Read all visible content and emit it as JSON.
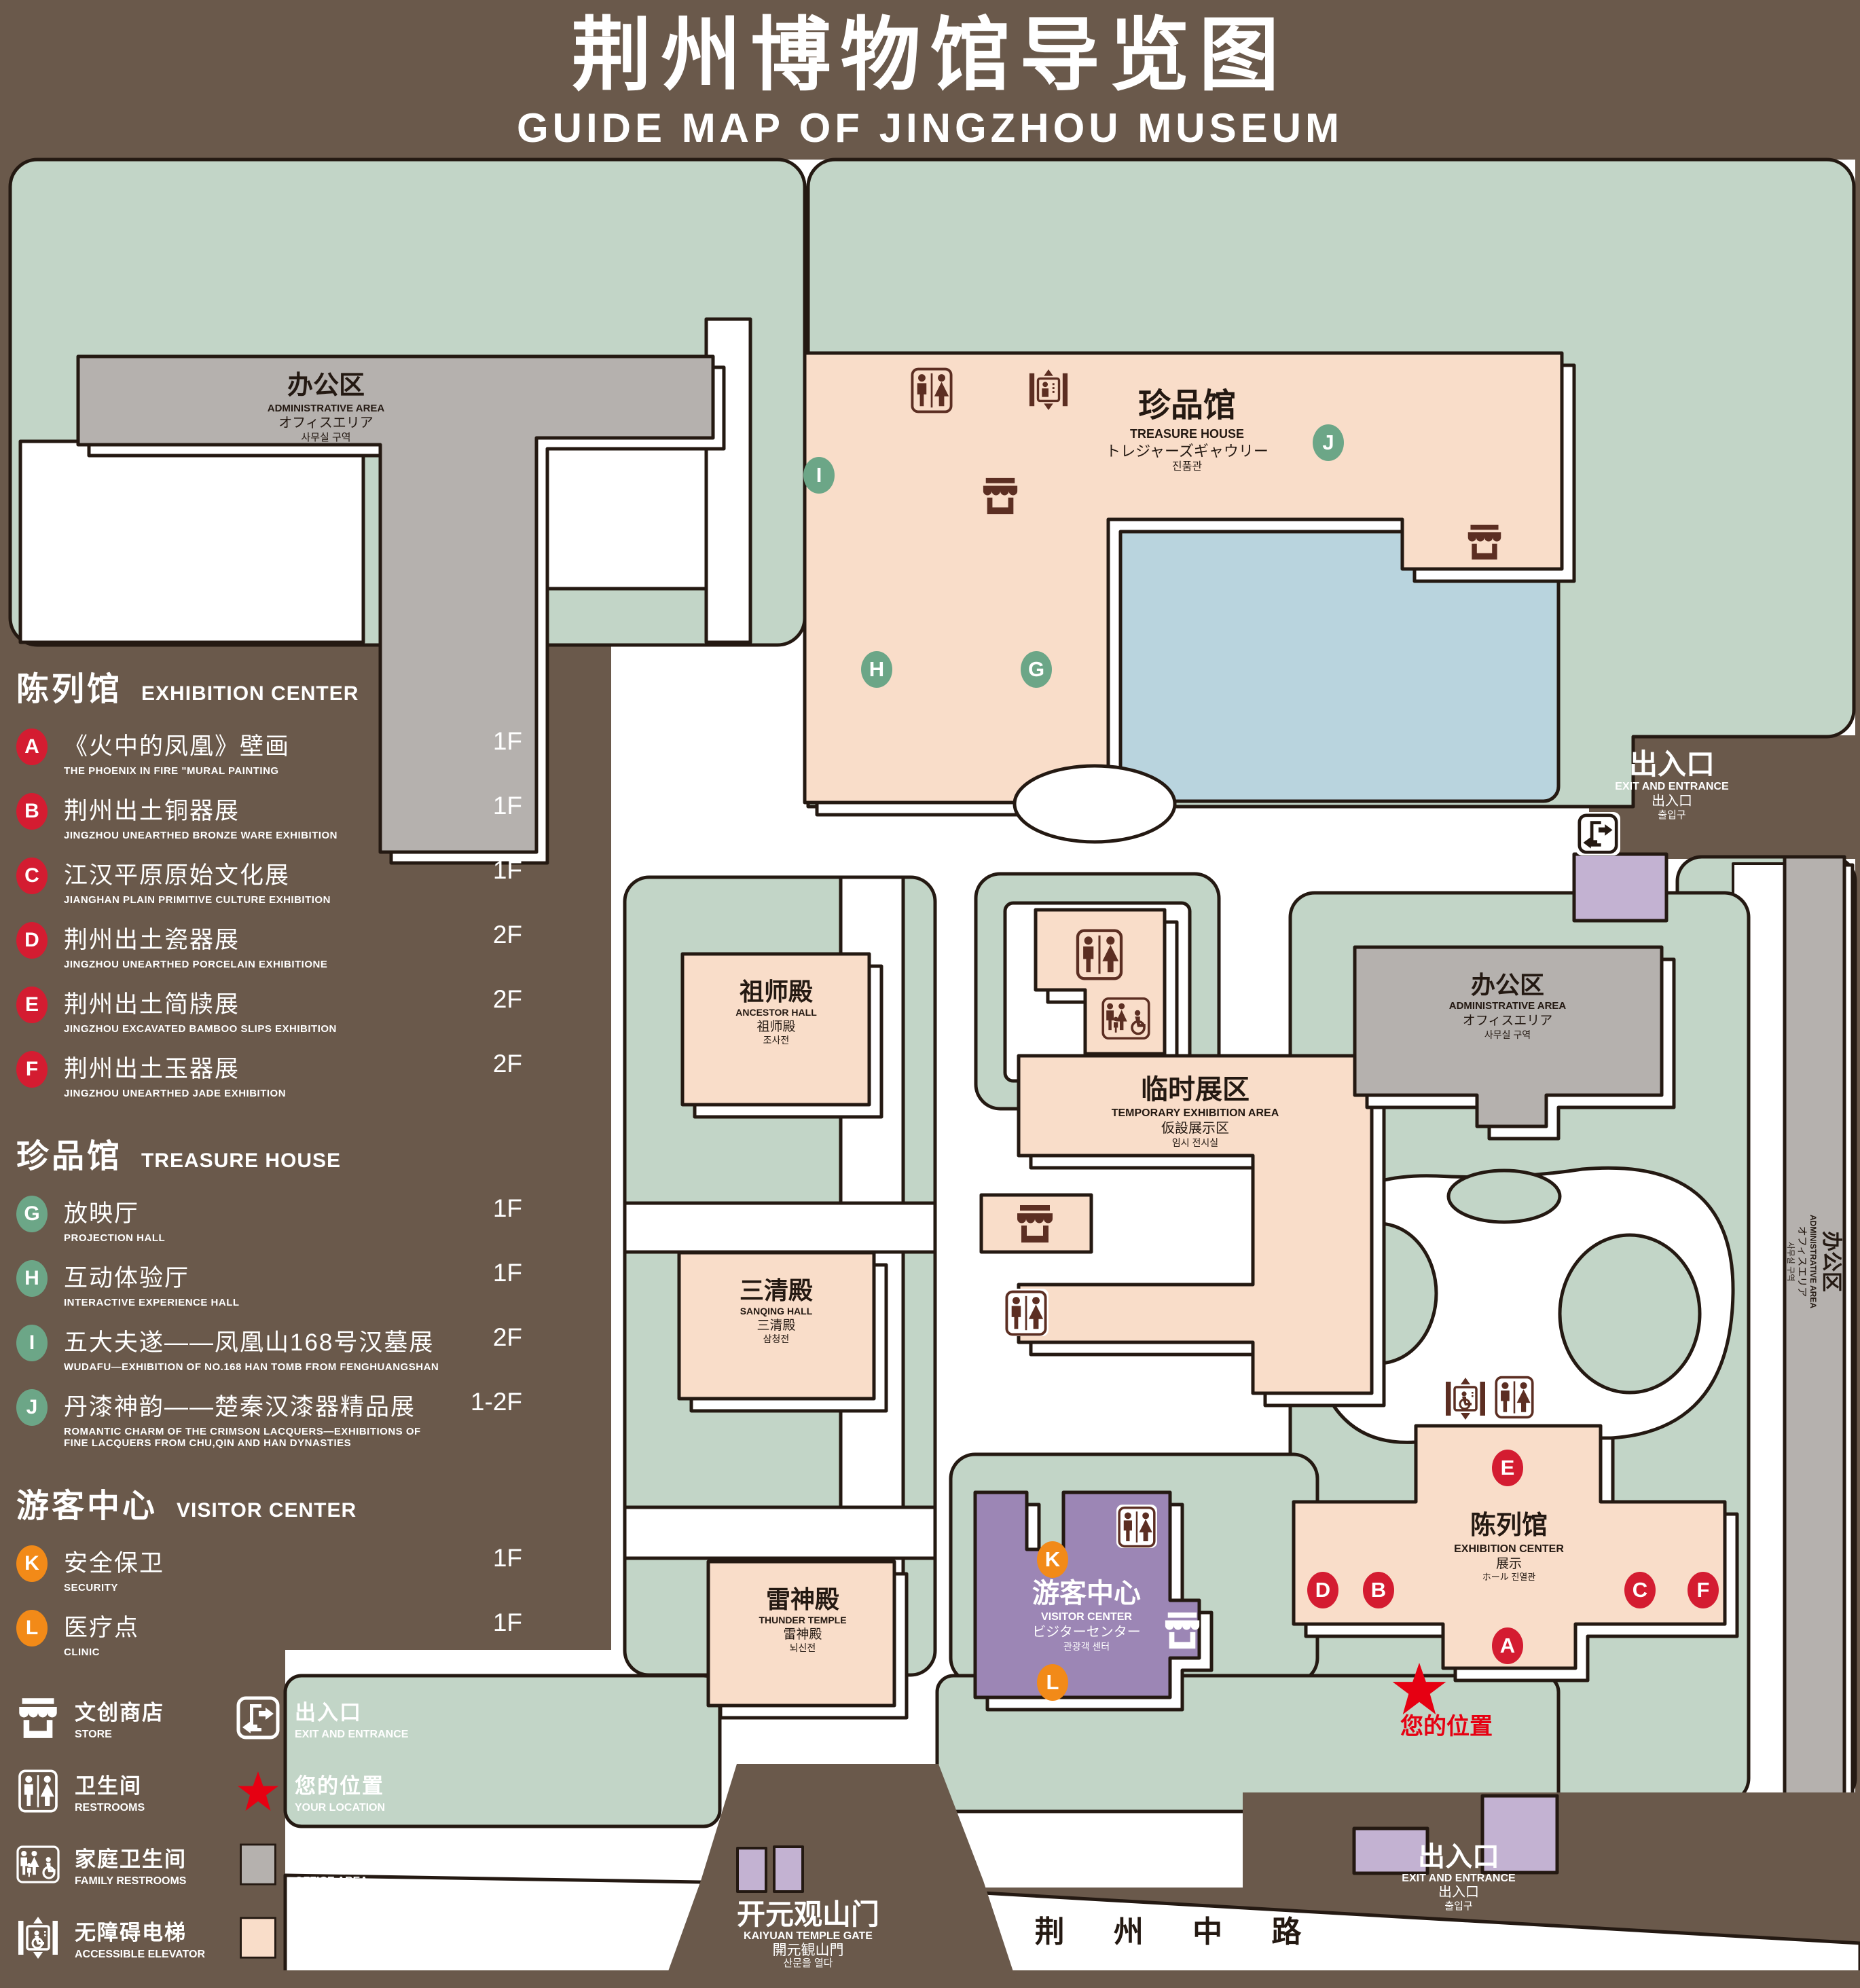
{
  "title": {
    "zh": "荆州博物馆导览图",
    "en": "GUIDE MAP OF JINGZHOU MUSEUM"
  },
  "colors": {
    "background_brown": "#6a594b",
    "map_green": "#c2d5c7",
    "path_white": "#ffffff",
    "building_pink": "#f9ddc9",
    "building_gray": "#b5b1ae",
    "lake_blue": "#b9d4de",
    "visitor_purple": "#9c86b5",
    "lavender": "#c3b2d2",
    "outline": "#241912",
    "badge_red": "#d41c31",
    "badge_green": "#6ca687",
    "badge_orange": "#f28a18",
    "icon_brown": "#5c2e22",
    "star_red": "#e60012"
  },
  "legend": {
    "sections": [
      {
        "zh": "陈列馆",
        "en": "EXHIBITION CENTER",
        "badge_color": "#d41c31",
        "items": [
          {
            "letter": "A",
            "zh": "《火中的凤凰》壁画",
            "en": "THE PHOENIX IN FIRE \"MURAL PAINTING",
            "floor": "1F",
            "badge_color": "#d41c31"
          },
          {
            "letter": "B",
            "zh": "荆州出土铜器展",
            "en": "JINGZHOU UNEARTHED BRONZE WARE EXHIBITION",
            "floor": "1F",
            "badge_color": "#d41c31"
          },
          {
            "letter": "C",
            "zh": "江汉平原原始文化展",
            "en": "JIANGHAN PLAIN PRIMITIVE CULTURE EXHIBITION",
            "floor": "1F",
            "badge_color": "#d41c31"
          },
          {
            "letter": "D",
            "zh": "荆州出土瓷器展",
            "en": "JINGZHOU UNEARTHED PORCELAIN EXHIBITIONE",
            "floor": "2F",
            "badge_color": "#d41c31"
          },
          {
            "letter": "E",
            "zh": "荆州出土简牍展",
            "en": "JINGZHOU EXCAVATED BAMBOO SLIPS EXHIBITION",
            "floor": "2F",
            "badge_color": "#d41c31"
          },
          {
            "letter": "F",
            "zh": "荆州出土玉器展",
            "en": "JINGZHOU UNEARTHED JADE EXHIBITION",
            "floor": "2F",
            "badge_color": "#d41c31"
          }
        ]
      },
      {
        "zh": "珍品馆",
        "en": "TREASURE HOUSE",
        "badge_color": "#6ca687",
        "items": [
          {
            "letter": "G",
            "zh": "放映厅",
            "en": "PROJECTION HALL",
            "floor": "1F",
            "badge_color": "#6ca687"
          },
          {
            "letter": "H",
            "zh": "互动体验厅",
            "en": "INTERACTIVE EXPERIENCE HALL",
            "floor": "1F",
            "badge_color": "#6ca687"
          },
          {
            "letter": "I",
            "zh": "五大夫遂——凤凰山168号汉墓展",
            "en": "WUDAFU—EXHIBITION OF NO.168 HAN TOMB FROM FENGHUANGSHAN",
            "floor": "2F",
            "badge_color": "#6ca687"
          },
          {
            "letter": "J",
            "zh": "丹漆神韵——楚秦汉漆器精品展",
            "en": "ROMANTIC CHARM OF THE CRIMSON LACQUERS—EXHIBITIONS OF FINE LACQUERS FROM CHU,QIN AND HAN DYNASTIES",
            "floor": "1-2F",
            "badge_color": "#6ca687"
          }
        ]
      },
      {
        "zh": "游客中心",
        "en": "VISITOR CENTER",
        "badge_color": "#f28a18",
        "items": [
          {
            "letter": "K",
            "zh": "安全保卫",
            "en": "SECURITY",
            "floor": "1F",
            "badge_color": "#f28a18"
          },
          {
            "letter": "L",
            "zh": "医疗点",
            "en": "CLINIC",
            "floor": "1F",
            "badge_color": "#f28a18"
          }
        ]
      }
    ],
    "facilities": [
      {
        "icon": "store",
        "zh": "文创商店",
        "en": "STORE"
      },
      {
        "icon": "exit",
        "zh": "出入口",
        "en": "EXIT AND ENTRANCE"
      },
      {
        "icon": "wc",
        "zh": "卫生间",
        "en": "RESTROOMS"
      },
      {
        "icon": "star",
        "zh": "您的位置",
        "en": "YOUR LOCATION"
      },
      {
        "icon": "family",
        "zh": "家庭卫生间",
        "en": "FAMILY RESTROOMS"
      },
      {
        "icon": "swatch-office",
        "zh": "办公区域",
        "en": "OFFICE AREA"
      },
      {
        "icon": "elev-acc",
        "zh": "无障碍电梯",
        "en": "ACCESSIBLE ELEVATOR"
      },
      {
        "icon": "swatch-display",
        "zh": "展示区域",
        "en": "DISPLAY AREA"
      },
      {
        "icon": "elev",
        "zh": "电梯",
        "en": "Elevator"
      }
    ]
  },
  "map": {
    "labels": {
      "admin": {
        "zh": "办公区",
        "en": "ADMINISTRATIVE AREA",
        "ja": "オフィスエリア",
        "ko": "사무실 구역"
      },
      "treasure": {
        "zh": "珍品馆",
        "en": "TREASURE HOUSE",
        "ja": "トレジャーズギャウリー",
        "ko": "진품관"
      },
      "ancestor": {
        "zh": "祖师殿",
        "en": "ANCESTOR HALL",
        "ja": "祖师殿",
        "ko": "조사전"
      },
      "sanqing": {
        "zh": "三清殿",
        "en": "SANQING HALL",
        "ja": "三清殿",
        "ko": "삼청전"
      },
      "thunder": {
        "zh": "雷神殿",
        "en": "THUNDER TEMPLE",
        "ja": "雷神殿",
        "ko": "뇌신전"
      },
      "temp": {
        "zh": "临时展区",
        "en": "TEMPORARY EXHIBITION AREA",
        "ja": "仮設展示区",
        "ko": "임시 전시실"
      },
      "visitor": {
        "zh": "游客中心",
        "en": "VISITOR CENTER",
        "ja": "ビジターセンター",
        "ko": "관광객 센터"
      },
      "exhibition": {
        "zh": "陈列馆",
        "en": "EXHIBITION CENTER",
        "ja": "展示",
        "ko": "ホール 진열관"
      },
      "exit": {
        "zh": "出入口",
        "en": "EXIT AND ENTRANCE",
        "ja": "出入口",
        "ko": "출입구"
      },
      "gate": {
        "zh": "开元观山门",
        "en": "KAIYUAN TEMPLE GATE",
        "ja": "開元観山門",
        "ko": "산문을 열다"
      },
      "road": "荆 州 中 路",
      "your_location": "您的位置"
    },
    "badges": {
      "A": "A",
      "B": "B",
      "C": "C",
      "D": "D",
      "E": "E",
      "F": "F",
      "G": "G",
      "H": "H",
      "I": "I",
      "J": "J",
      "K": "K",
      "L": "L"
    }
  }
}
